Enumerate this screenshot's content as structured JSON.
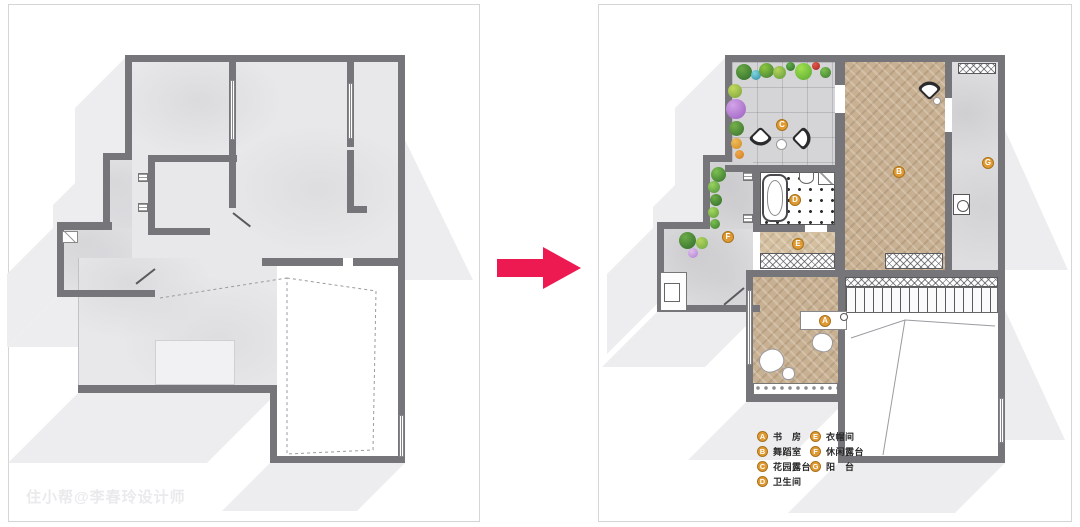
{
  "watermark": "住小帮@李春玲设计师",
  "legend": {
    "items": [
      {
        "letter": "A",
        "label": "书　房"
      },
      {
        "letter": "B",
        "label": "舞蹈室"
      },
      {
        "letter": "C",
        "label": "花园露台"
      },
      {
        "letter": "D",
        "label": "卫生间"
      },
      {
        "letter": "E",
        "label": "衣帽间"
      },
      {
        "letter": "F",
        "label": "休闲露台"
      },
      {
        "letter": "G",
        "label": "阳　台"
      }
    ]
  },
  "colors": {
    "arrow": "#ED1A52",
    "wall": "#76767A",
    "badge": "#E09A33",
    "wood_floor": "#C8B092",
    "concrete_floor": "#E8E8EA"
  }
}
